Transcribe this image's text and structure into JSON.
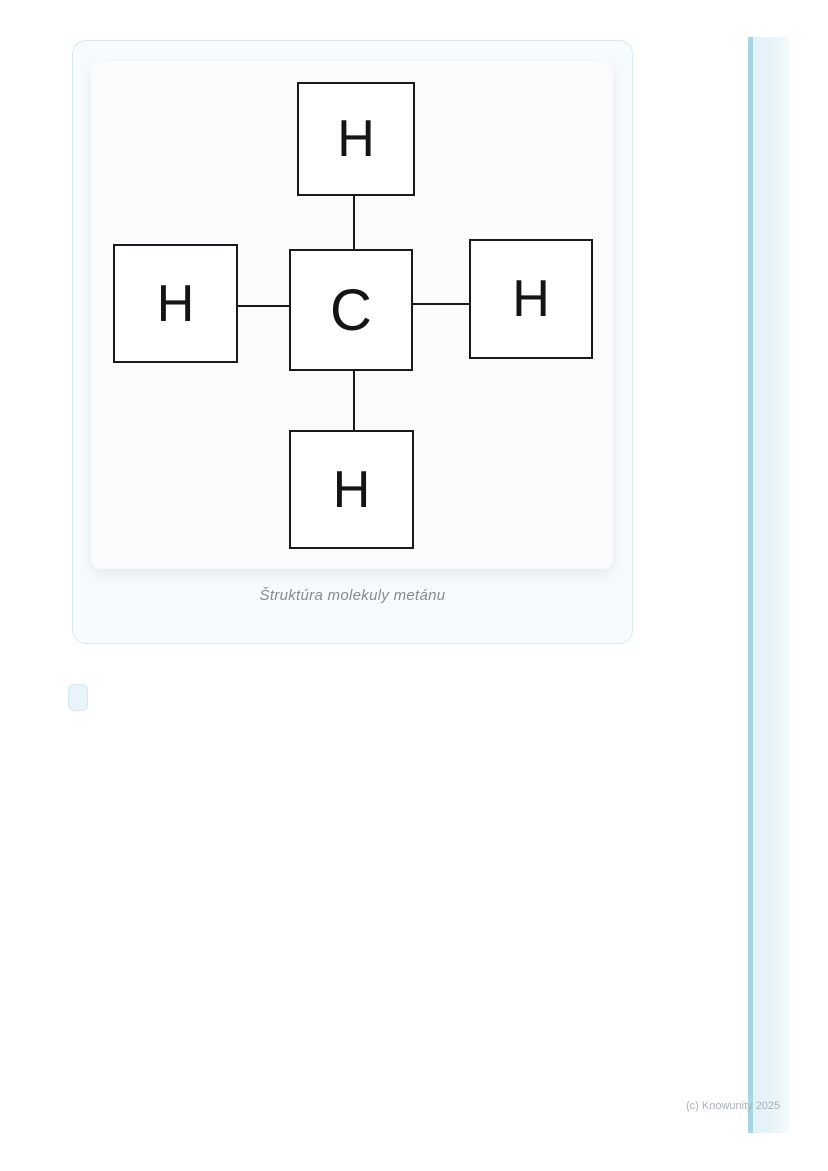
{
  "figure": {
    "caption": "Štruktúra molekuly metánu",
    "molecule": {
      "type": "structural-formula",
      "atoms": [
        {
          "id": "h-top",
          "symbol": "H",
          "position": "top"
        },
        {
          "id": "h-left",
          "symbol": "H",
          "position": "left"
        },
        {
          "id": "c-center",
          "symbol": "C",
          "position": "center"
        },
        {
          "id": "h-right",
          "symbol": "H",
          "position": "right"
        },
        {
          "id": "h-bottom",
          "symbol": "H",
          "position": "bottom"
        }
      ],
      "bonds": [
        {
          "from": "c-center",
          "to": "h-top"
        },
        {
          "from": "c-center",
          "to": "h-left"
        },
        {
          "from": "c-center",
          "to": "h-right"
        },
        {
          "from": "c-center",
          "to": "h-bottom"
        }
      ]
    }
  },
  "footer": {
    "copyright": "(c) Knowunity 2025"
  },
  "colors": {
    "card_border": "#d6eaf3",
    "card_background": "#f7fbfd",
    "panel_background": "#fafbfc",
    "box_border": "#1a1a1a",
    "caption_text": "#858b94",
    "copyright_text": "#a9b0b8",
    "stripe_accent": "#a6d6e4",
    "stripe_fill": "#e1f1f7",
    "placeholder_fill": "#e9f4fa",
    "placeholder_border": "#d5e8f1"
  }
}
